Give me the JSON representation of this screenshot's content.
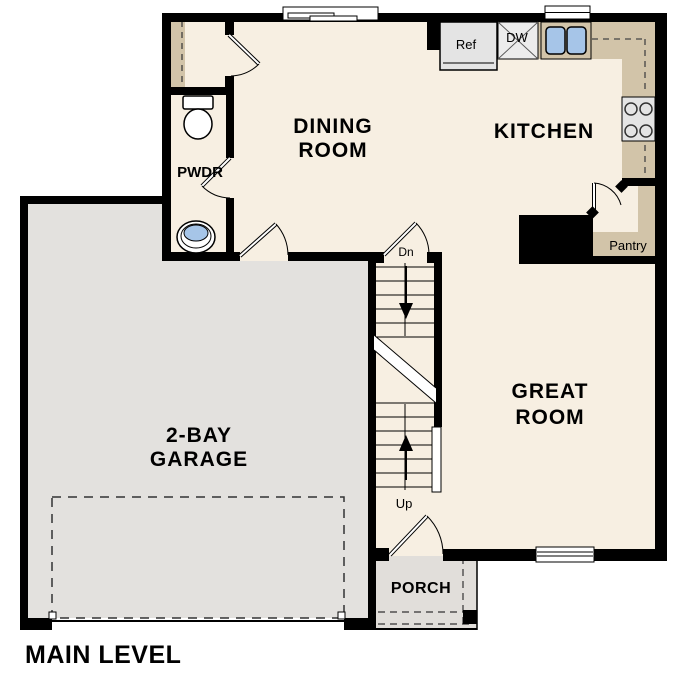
{
  "plan_title": "MAIN LEVEL",
  "rooms": {
    "dining": {
      "line1": "DINING",
      "line2": "ROOM"
    },
    "kitchen": {
      "label": "KITCHEN"
    },
    "great": {
      "line1": "GREAT",
      "line2": "ROOM"
    },
    "garage": {
      "line1": "2-BAY",
      "line2": "GARAGE"
    },
    "pwdr": {
      "label": "PWDR"
    },
    "porch": {
      "label": "PORCH"
    },
    "pantry": {
      "label": "Pantry"
    }
  },
  "appliances": {
    "fridge": "Ref",
    "dishwasher": "DW"
  },
  "stairs": {
    "down_label": "Dn",
    "up_label": "Up"
  },
  "colors": {
    "floor": "#f7efe2",
    "garage_floor": "#e3e1de",
    "porch_floor": "#e1dedา",
    "counter": "#d2c4a9",
    "wall": "#000000",
    "sink_blue": "#a6c5e8",
    "appliance": "#e4e4e4"
  }
}
